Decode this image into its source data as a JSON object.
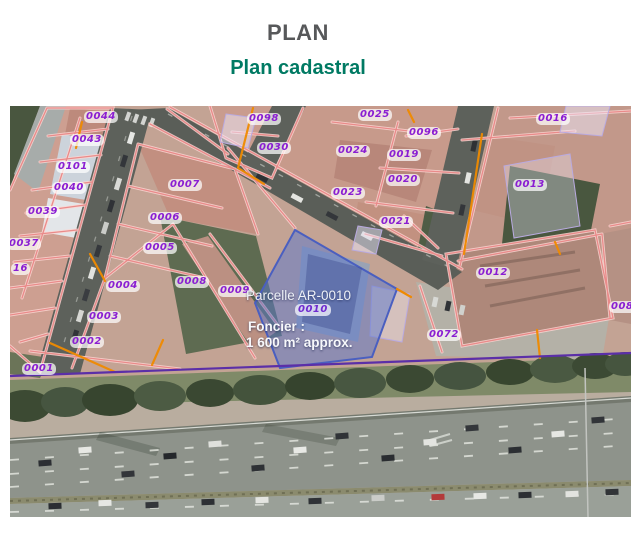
{
  "header": {
    "title": "PLAN",
    "subtitle": "Plan cadastral"
  },
  "map": {
    "type": "cadastral-aerial-photo",
    "highlight": {
      "parcel_title": "Parcelle AR-0010",
      "parcel_code": "0010",
      "foncier_label": "Foncier :",
      "foncier_area": "1 600 m² approx."
    },
    "parcel_labels": [
      {
        "text": "0044"
      },
      {
        "text": "0043"
      },
      {
        "text": "0101"
      },
      {
        "text": "0040"
      },
      {
        "text": "0039"
      },
      {
        "text": "0037"
      },
      {
        "text": "16"
      },
      {
        "text": "0004"
      },
      {
        "text": "0003"
      },
      {
        "text": "0002"
      },
      {
        "text": "0001"
      },
      {
        "text": "0007"
      },
      {
        "text": "0006"
      },
      {
        "text": "0005"
      },
      {
        "text": "0008"
      },
      {
        "text": "0009"
      },
      {
        "text": "0098"
      },
      {
        "text": "0030"
      },
      {
        "text": "0025"
      },
      {
        "text": "0096"
      },
      {
        "text": "0024"
      },
      {
        "text": "0019"
      },
      {
        "text": "0020"
      },
      {
        "text": "0023"
      },
      {
        "text": "0021"
      },
      {
        "text": "0016"
      },
      {
        "text": "0013"
      },
      {
        "text": "0012"
      },
      {
        "text": "0072"
      },
      {
        "text": "0084"
      }
    ],
    "colors": {
      "title_gray": "#57585a",
      "subtitle_teal": "#007a63",
      "parcel_label_purple": "#8a1ed2",
      "parcel_line_pink": "#e98b8a",
      "boundary_orange": "#ef8a00",
      "highlight_blue_fill": "#5a78cd",
      "highlight_blue_stroke": "#4a5fc0",
      "section_line_purple": "#5b2fa8"
    }
  }
}
